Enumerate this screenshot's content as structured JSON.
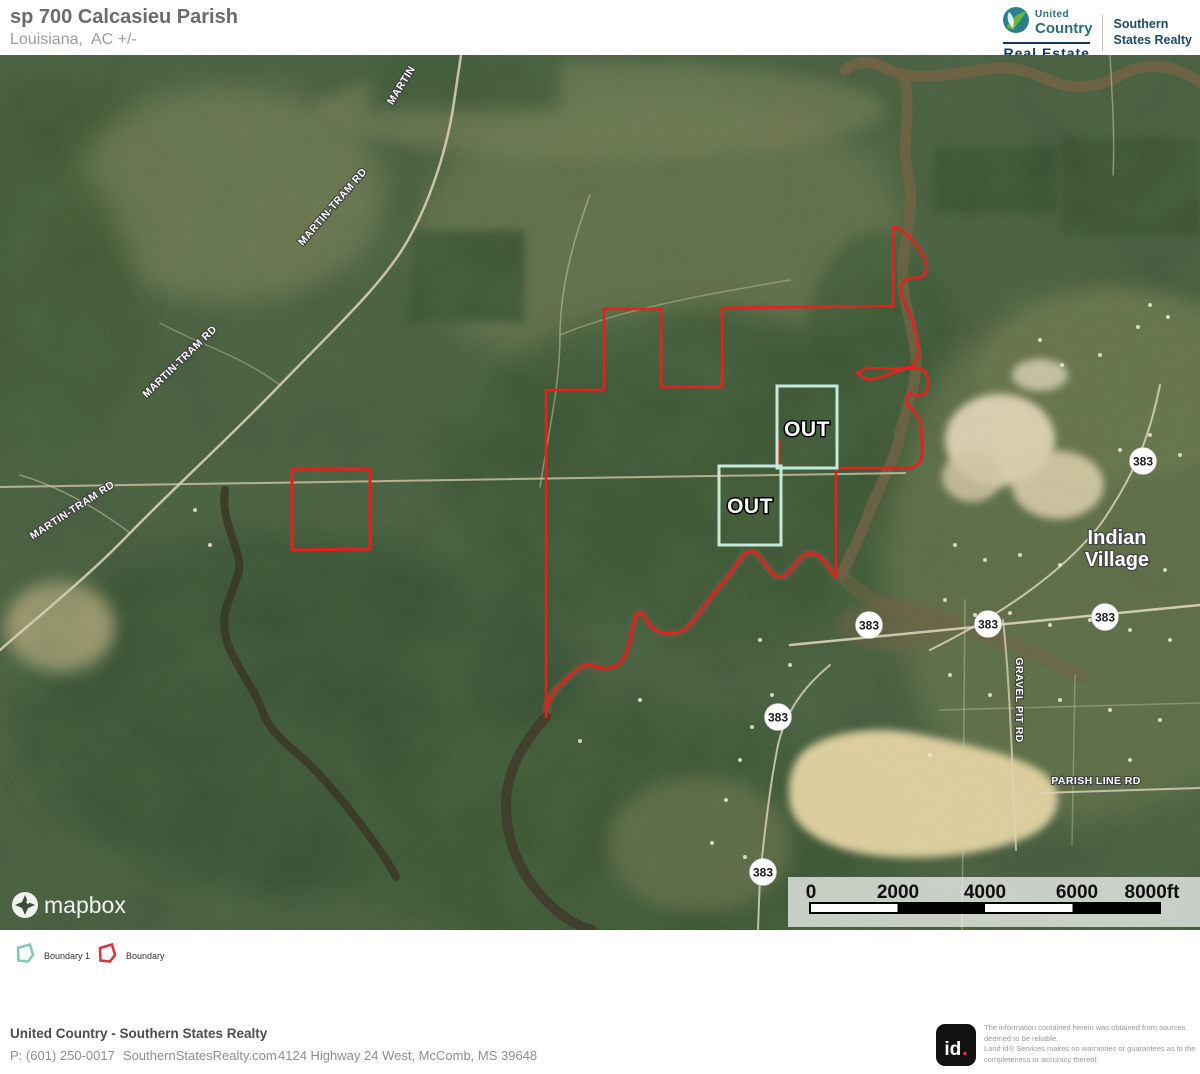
{
  "header": {
    "title": "sp 700 Calcasieu Parish",
    "subtitle": "Louisiana,  AC +/-",
    "logo": {
      "united": "United",
      "country": "Country",
      "real_estate": "Real Estate",
      "southern": "Southern",
      "states_realty": "States Realty"
    }
  },
  "map": {
    "out_label": "OUT",
    "shield": "383",
    "place": {
      "line1": "Indian",
      "line2": "Village"
    },
    "roads": {
      "martin": "MARTIN",
      "martin_tram": "MARTIN-TRAM RD",
      "gravel_pit": "GRAVEL PIT RD",
      "parish_line": "PARISH LINE RD"
    },
    "mapbox": "mapbox",
    "scalebar": {
      "labels": [
        "0",
        "2000",
        "4000",
        "6000",
        "8000ft"
      ]
    },
    "boundary_color": "#e8201d",
    "out_box_color": "#c4ead9"
  },
  "legend": {
    "items": [
      {
        "label": "Boundary 1",
        "color": "#86c7b2"
      },
      {
        "label": "Boundary",
        "color": "#d4393c"
      }
    ]
  },
  "footer": {
    "company": "United Country - Southern States Realty",
    "phone": "P: (601) 250-0017",
    "website": "SouthernStatesRealty.com",
    "address": "4124 Highway 24 West, McComb, MS 39648",
    "id_text": "id",
    "id_dot": ".",
    "disclaimer_lines": [
      "The information contained herein was obtained from sources",
      "deemed to be reliable.",
      " Land id® Services makes no warranties or guarantees as to the",
      "completeness or accuracy thereof."
    ]
  }
}
